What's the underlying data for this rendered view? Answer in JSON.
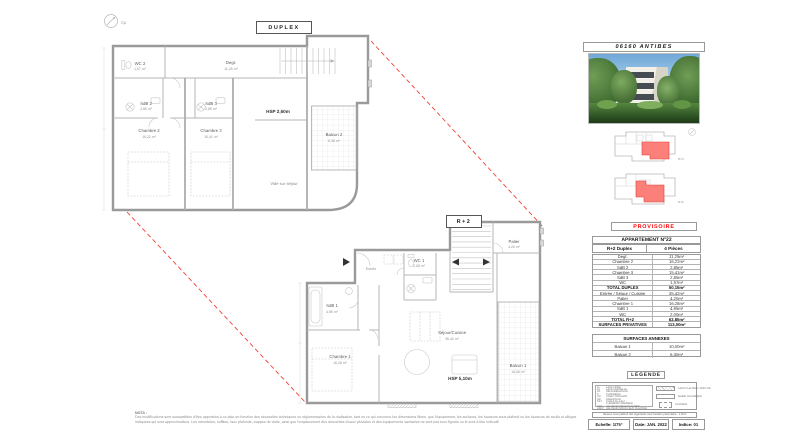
{
  "sheet": {
    "compass_label": "Cp",
    "tags": {
      "duplex": "DUPLEX",
      "r2": "R+2"
    },
    "nota": {
      "title": "NOTA :",
      "text": "Des modifications sont susceptibles d'être apportées à ce plan en fonction des nécessités techniques ou réglementaires de la réalisation, tant en ce qui concerne les dimensions libres, que l'équipement, les surfaces, les hauteurs sous plafond ou les hauteurs de seuils et allèges indiquées qui sont approximatives. Les retombées, soffites, faux plafonds, trappes de visite, ainsi que l'emplacement des descentes d'eaux pluviales et des équipements sanitaires ne sont pas tous figurés ou le sont à titre indicatif."
    }
  },
  "plans": {
    "duplex": {
      "rooms": {
        "wc2": {
          "name": "WC 2",
          "area": "1,57 m²"
        },
        "sdb2": {
          "name": "SdB 2",
          "area": "2,85 m²"
        },
        "sdb3": {
          "name": "SdB 3",
          "area": "2,85 m²"
        },
        "ch2": {
          "name": "Chambre 2",
          "area": "16,22 m²"
        },
        "ch3": {
          "name": "Chambre 3",
          "area": "15,41 m²"
        },
        "degt": {
          "name": "Degt.",
          "area": "11,25 m²"
        },
        "balcon2": {
          "name": "Balcon 2",
          "area": "6,30 m²"
        },
        "vide": {
          "name": "Vide sur séjour"
        },
        "hsp": {
          "name": "HSP 2,60m"
        }
      }
    },
    "r2": {
      "rooms": {
        "sdb1": {
          "name": "SdB 1",
          "area": "4,95 m²"
        },
        "ch1": {
          "name": "Chambre 1",
          "area": "16,28 m²"
        },
        "entree": {
          "name": "Entrée"
        },
        "wc1": {
          "name": "WC 1",
          "area": "2,00 m²"
        },
        "sejour": {
          "name": "Séjour/Cuisine",
          "area": "35,42 m²"
        },
        "palier": {
          "name": "Palier",
          "area": "4,20 m²"
        },
        "balcon1": {
          "name": "Balcon 1",
          "area": "10,00 m²"
        },
        "hsp": {
          "name": "HSP 5,10m"
        }
      }
    }
  },
  "panel": {
    "location": "06160 ANTIBES",
    "keyplans": {
      "upper": "R+3",
      "lower": "R+2"
    },
    "provisoire": "PROVISOIRE",
    "apartment": {
      "title": "APPARTEMENT N°22",
      "type": "R+2 Duplex",
      "pieces": "4 Pièces"
    },
    "table": {
      "rows": [
        {
          "label": "Degt.",
          "value": "11,25m²"
        },
        {
          "label": "Chambre 2",
          "value": "16,22m²"
        },
        {
          "label": "SdB 2",
          "value": "2,85m²"
        },
        {
          "label": "Chambre 3",
          "value": "15,41m²"
        },
        {
          "label": "SdB 3",
          "value": "2,85m²"
        },
        {
          "label": "WC",
          "value": "1,57m²"
        },
        {
          "label": "TOTAL DUPLEX",
          "value": "50,15m²"
        },
        {
          "label": "Entrée / Séjour / Cuisine",
          "value": "35,42m²"
        },
        {
          "label": "Palier",
          "value": "4,20m²"
        },
        {
          "label": "Chambre 1",
          "value": "16,28m²"
        },
        {
          "label": "SdB 1",
          "value": "4,95m²"
        },
        {
          "label": "WC",
          "value": "2,00m²"
        },
        {
          "label": "TOTAL R+2",
          "value": "62,85m²"
        },
        {
          "label": "SURFACES PRIVATIVES",
          "value": "113,00m²"
        }
      ]
    },
    "annexes": {
      "title": "SURFACES ANNEXES",
      "rows": [
        {
          "label": "Balcon 1",
          "value": "10,00m²"
        },
        {
          "label": "Balcon 2",
          "value": "6,30m²"
        }
      ]
    },
    "legend": {
      "title": "LÉGENDE",
      "items": [
        {
          "abbr": "LL",
          "label": "LAVE-LINGE"
        },
        {
          "abbr": "LV",
          "label": "LAVE-VAISSELLE"
        },
        {
          "abbr": "RF",
          "label": "RÉFRIGÉRATEUR"
        },
        {
          "abbr": "C",
          "label": "CUISINIÈRE"
        },
        {
          "abbr": "VR",
          "label": "VOLET ROULANT"
        },
        {
          "abbr": "RD",
          "label": "RADIATEUR"
        },
        {
          "abbr": "CET",
          "label": "CHAUFFE-EAU THERMODYNAMIQUE"
        },
        {
          "abbr": "HSP",
          "label": "HAUTEUR SOUS PLAFOND"
        },
        {
          "abbr": "HSFP",
          "label": "HAUTEUR SOUS FAUX PLAFOND"
        }
      ],
      "symbols": [
        {
          "label": "FAUX PLAFOND / SOFFITE"
        },
        {
          "label": "GAINE TECHNIQUE"
        },
        {
          "label": "PLACARD"
        }
      ],
      "note": "Hauteur sous plafond des logements sauf mention particulière : 2,50m"
    },
    "footer": {
      "scale": "Echelle: 1/75°",
      "date": "Date: JAN. 2022",
      "indice": "Indice: 01"
    }
  }
}
